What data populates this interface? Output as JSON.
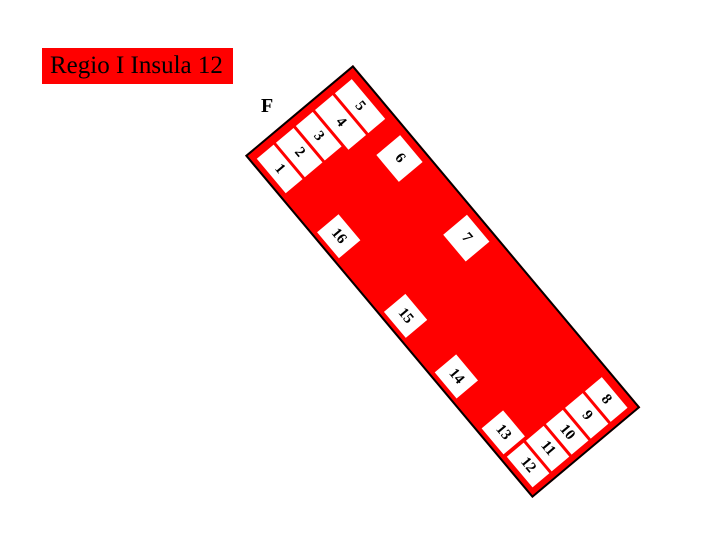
{
  "title": {
    "text": "Regio I Insula 12"
  },
  "map": {
    "street_label": "F",
    "entrances": [
      "1",
      "2",
      "3",
      "4",
      "5",
      "6",
      "7",
      "8",
      "9",
      "10",
      "11",
      "12",
      "13",
      "14",
      "15",
      "16"
    ]
  },
  "colors": {
    "insula_fill": "#ff0000",
    "entrance_fill": "#ffffff",
    "outline": "#000000",
    "text": "#000000"
  }
}
